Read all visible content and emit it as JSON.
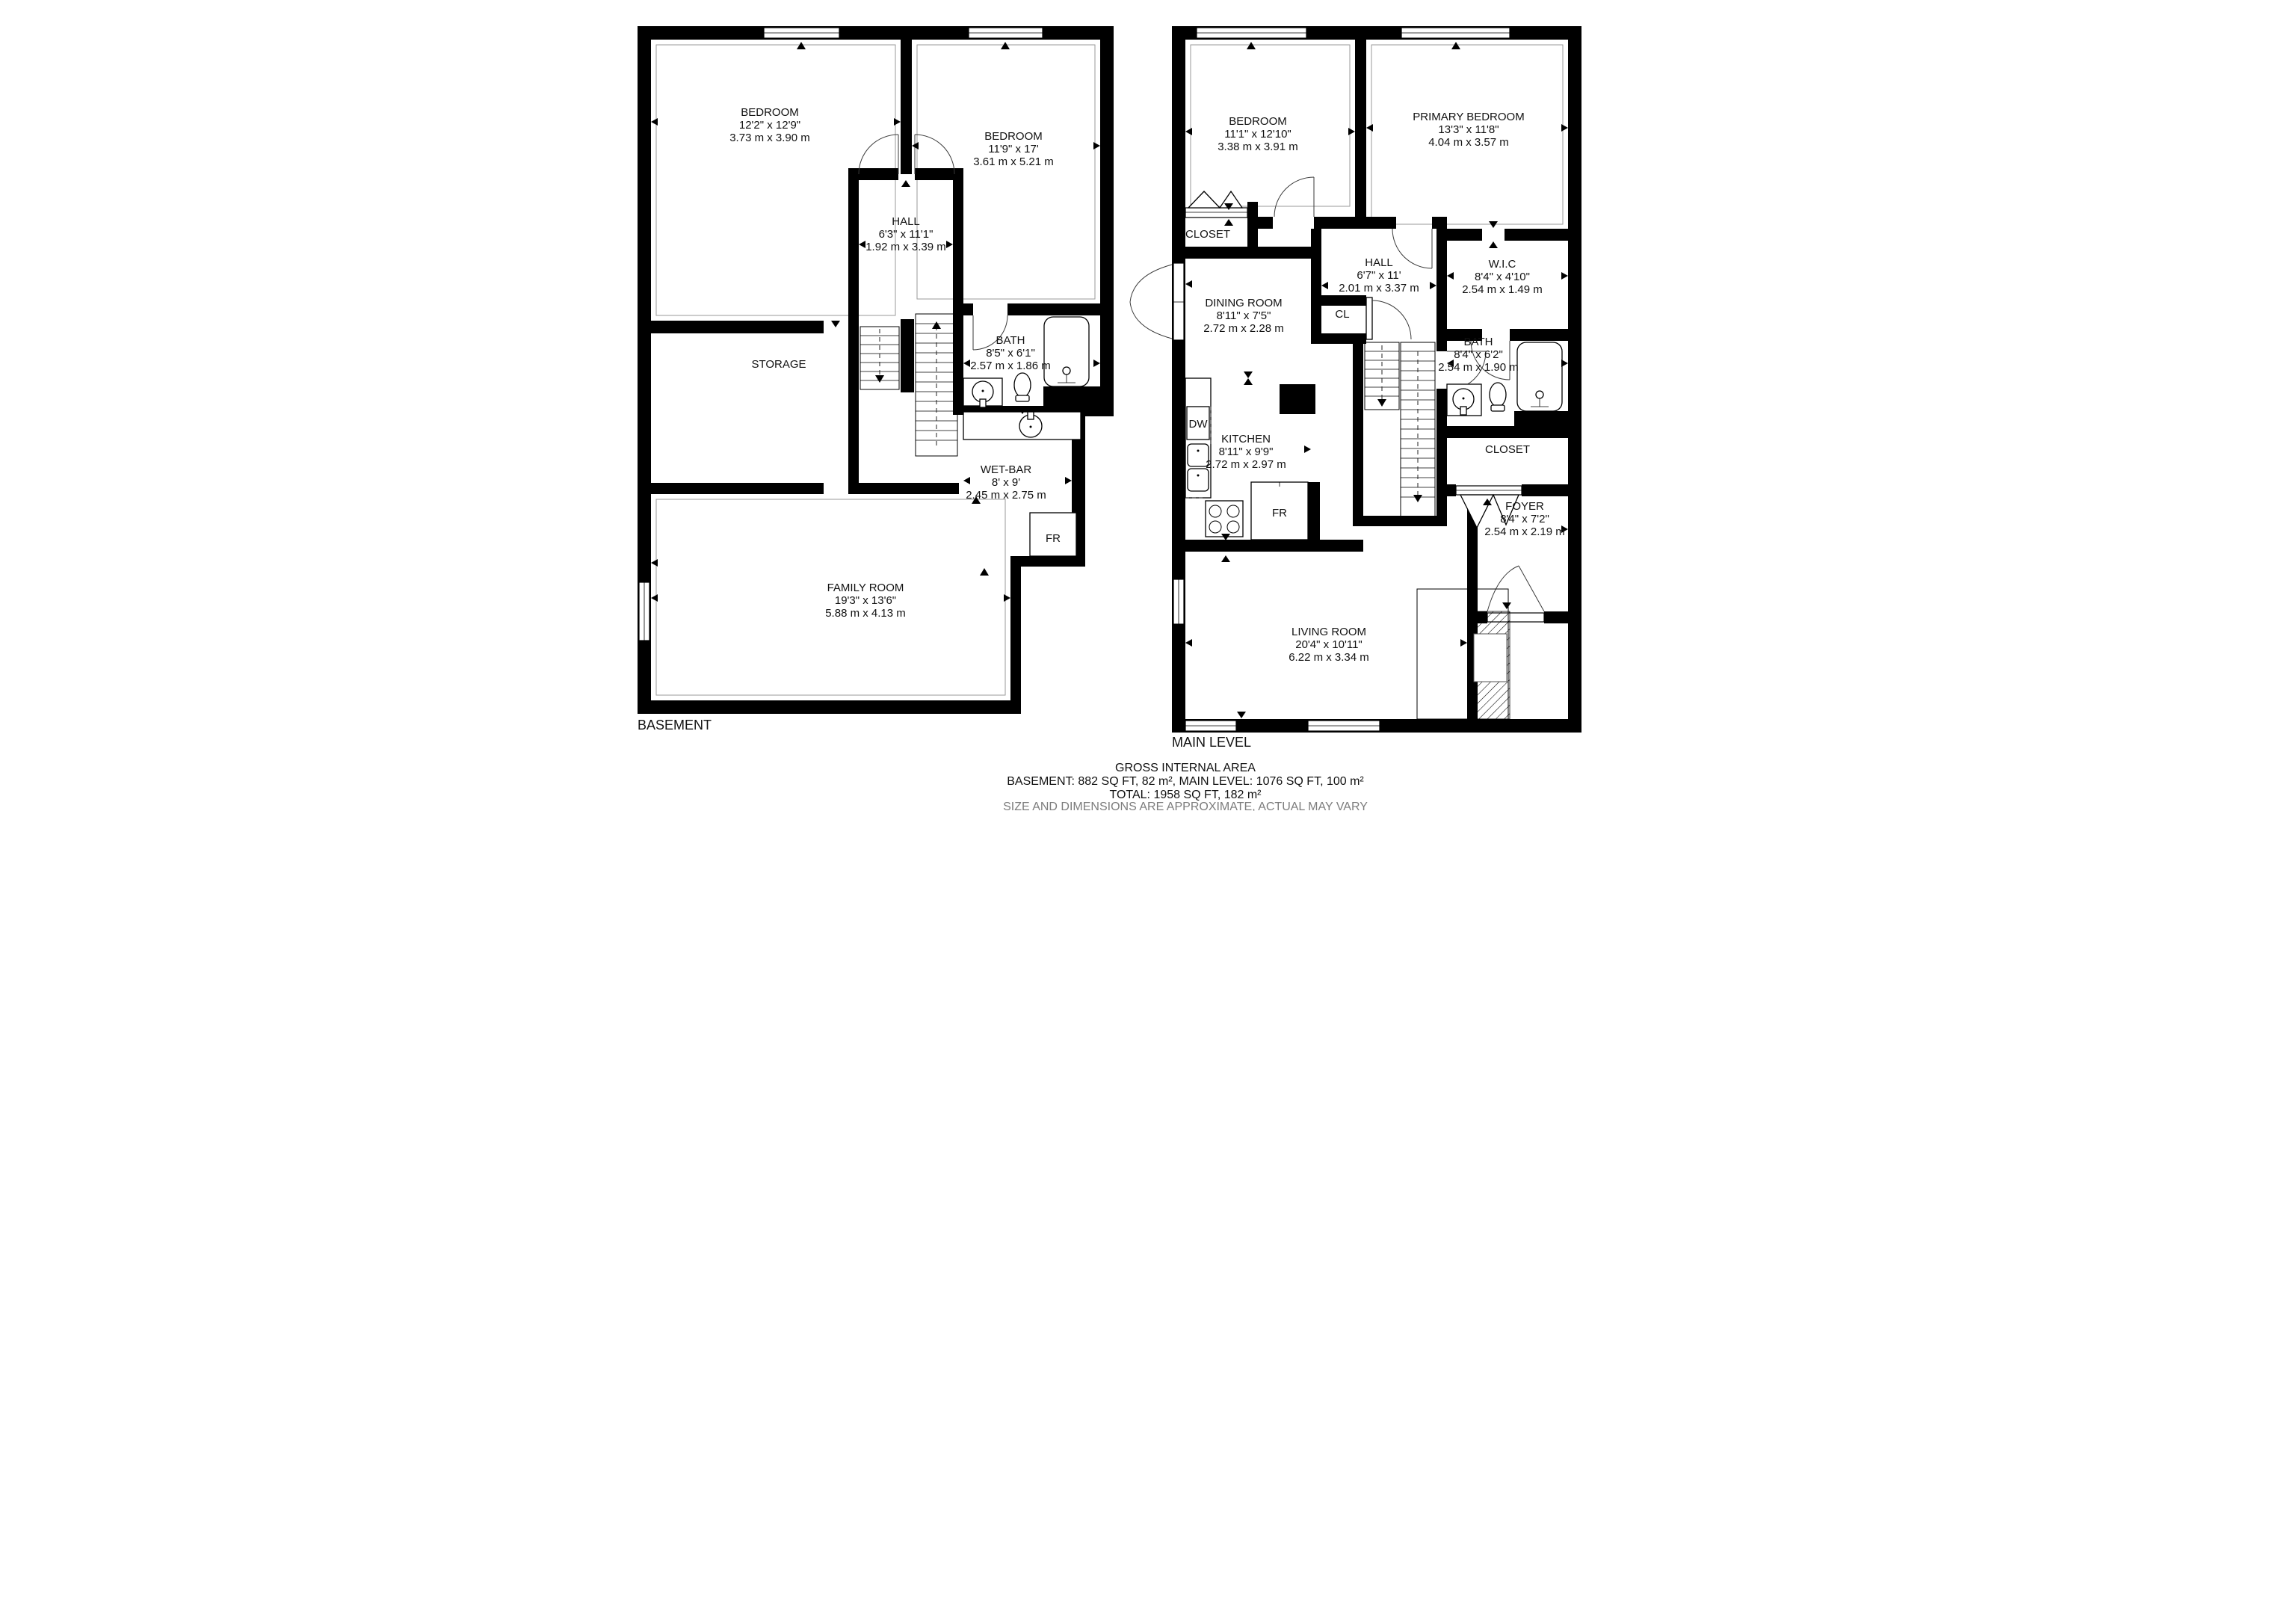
{
  "colors": {
    "wall": "#000000",
    "background": "#ffffff",
    "muted_text": "#7d7d7d"
  },
  "floors": [
    {
      "label": "BASEMENT",
      "rooms": [
        {
          "name": "BEDROOM",
          "imperial": "12'2\" x 12'9\"",
          "metric": "3.73 m x 3.90 m"
        },
        {
          "name": "BEDROOM",
          "imperial": "11'9\" x 17'",
          "metric": "3.61 m x 5.21 m"
        },
        {
          "name": "HALL",
          "imperial": "6'3\" x 11'1\"",
          "metric": "1.92 m x 3.39 m"
        },
        {
          "name": "STORAGE"
        },
        {
          "name": "BATH",
          "imperial": "8'5\" x 6'1\"",
          "metric": "2.57 m x 1.86 m"
        },
        {
          "name": "WET-BAR",
          "imperial": "8' x 9'",
          "metric": "2.45 m x 2.75 m"
        },
        {
          "name": "FAMILY ROOM",
          "imperial": "19'3\" x 13'6\"",
          "metric": "5.88 m x 4.13 m"
        }
      ],
      "appliances": [
        {
          "label": "FR"
        }
      ]
    },
    {
      "label": "MAIN LEVEL",
      "rooms": [
        {
          "name": "BEDROOM",
          "imperial": "11'1\" x 12'10\"",
          "metric": "3.38 m x 3.91 m"
        },
        {
          "name": "PRIMARY BEDROOM",
          "imperial": "13'3\" x 11'8\"",
          "metric": "4.04 m x 3.57 m"
        },
        {
          "name": "CLOSET"
        },
        {
          "name": "HALL",
          "imperial": "6'7\" x 11'",
          "metric": "2.01 m x 3.37 m"
        },
        {
          "name": "W.I.C",
          "imperial": "8'4\" x 4'10\"",
          "metric": "2.54 m x 1.49 m"
        },
        {
          "name": "DINING ROOM",
          "imperial": "8'11\" x 7'5\"",
          "metric": "2.72 m x 2.28 m"
        },
        {
          "name": "CL"
        },
        {
          "name": "BATH",
          "imperial": "8'4\" x 6'2\"",
          "metric": "2.54 m x 1.90 m"
        },
        {
          "name": "KITCHEN",
          "imperial": "8'11\" x 9'9\"",
          "metric": "2.72 m x 2.97 m"
        },
        {
          "name": "CLOSET"
        },
        {
          "name": "FOYER",
          "imperial": "8'4\" x 7'2\"",
          "metric": "2.54 m x 2.19 m"
        },
        {
          "name": "LIVING ROOM",
          "imperial": "20'4\" x 10'11\"",
          "metric": "6.22 m x 3.34 m"
        }
      ],
      "appliances": [
        {
          "label": "DW"
        },
        {
          "label": "FR"
        }
      ]
    }
  ],
  "footer": {
    "title": "GROSS INTERNAL AREA",
    "areas": "BASEMENT: 882 SQ FT, 82 m², MAIN LEVEL: 1076 SQ FT, 100 m²",
    "total": "TOTAL: 1958 SQ FT, 182 m²",
    "disclaimer": "SIZE AND DIMENSIONS ARE APPROXIMATE, ACTUAL MAY VARY"
  }
}
